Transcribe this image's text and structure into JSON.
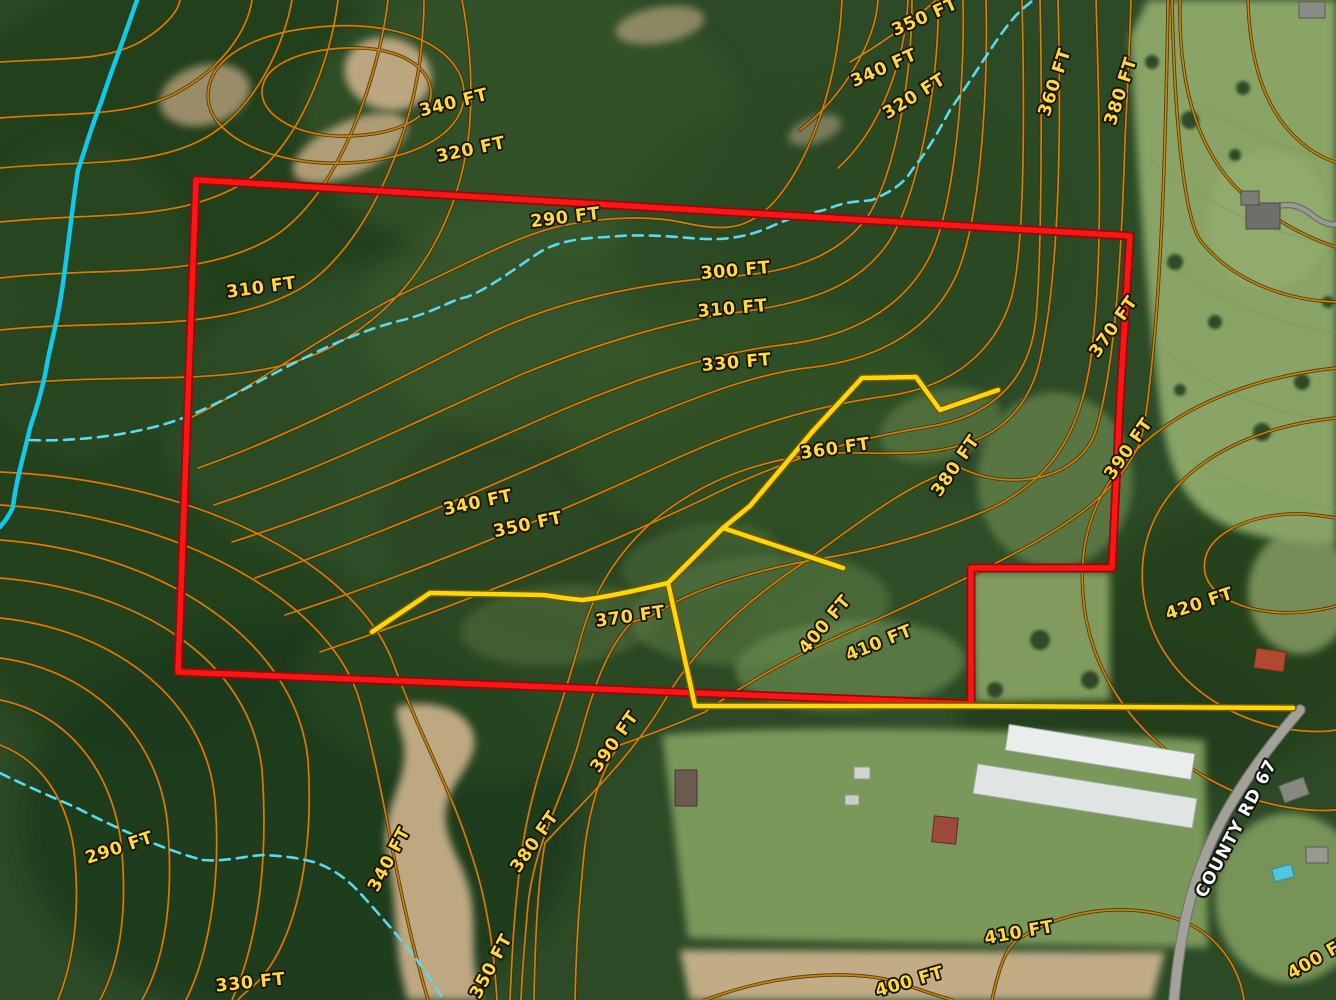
{
  "title": "Aerial topographic parcel map with contour lines, property boundary, trails and County Rd 67",
  "road_label": {
    "text": "COUNTY RD 67",
    "x": 1241,
    "y": 831,
    "rot": -62
  },
  "colors": {
    "forest": "#2c4a26",
    "forest_dark": "#213c1d",
    "forest_light": "#3e5e31",
    "contour": "#c8830b",
    "contour_casing": "#42310a",
    "label_fill": "#ffd83d",
    "boundary_red": "#ff1414",
    "boundary_casing": "#8f0c0c",
    "trail_yellow": "#ffd60a",
    "trail_casing": "#6f5600",
    "stream_solid": "#12c9ea",
    "stream_dashed": "#5cd9ef",
    "road_gray": "#a3a29a",
    "pasture": "#8ea969",
    "dirt": "#c6ae87"
  },
  "contour_labels": [
    {
      "t": "340 FT",
      "x": 455,
      "y": 108,
      "r": -14
    },
    {
      "t": "320 FT",
      "x": 472,
      "y": 155,
      "r": -12
    },
    {
      "t": "350 FT",
      "x": 927,
      "y": 22,
      "r": -24
    },
    {
      "t": "340 FT",
      "x": 886,
      "y": 73,
      "r": -24
    },
    {
      "t": "320 FT",
      "x": 917,
      "y": 101,
      "r": -32
    },
    {
      "t": "360 FT",
      "x": 1060,
      "y": 84,
      "r": -72
    },
    {
      "t": "380 FT",
      "x": 1126,
      "y": 93,
      "r": -72
    },
    {
      "t": "290 FT",
      "x": 566,
      "y": 223,
      "r": -7
    },
    {
      "t": "310 FT",
      "x": 262,
      "y": 293,
      "r": -8
    },
    {
      "t": "300 FT",
      "x": 736,
      "y": 276,
      "r": -5
    },
    {
      "t": "310 FT",
      "x": 733,
      "y": 314,
      "r": -5
    },
    {
      "t": "330 FT",
      "x": 737,
      "y": 368,
      "r": -5
    },
    {
      "t": "370 FT",
      "x": 1118,
      "y": 330,
      "r": -55
    },
    {
      "t": "360 FT",
      "x": 836,
      "y": 454,
      "r": -8
    },
    {
      "t": "380 FT",
      "x": 960,
      "y": 469,
      "r": -55
    },
    {
      "t": "390 FT",
      "x": 1133,
      "y": 452,
      "r": -55
    },
    {
      "t": "340 FT",
      "x": 479,
      "y": 508,
      "r": -12
    },
    {
      "t": "350 FT",
      "x": 529,
      "y": 530,
      "r": -12
    },
    {
      "t": "370 FT",
      "x": 631,
      "y": 622,
      "r": -8
    },
    {
      "t": "400 FT",
      "x": 829,
      "y": 628,
      "r": -50
    },
    {
      "t": "410 FT",
      "x": 881,
      "y": 648,
      "r": -22
    },
    {
      "t": "420 FT",
      "x": 1201,
      "y": 609,
      "r": -18
    },
    {
      "t": "290 FT",
      "x": 121,
      "y": 853,
      "r": -18
    },
    {
      "t": "340 FT",
      "x": 394,
      "y": 862,
      "r": -62
    },
    {
      "t": "330 FT",
      "x": 251,
      "y": 988,
      "r": -6
    },
    {
      "t": "390 FT",
      "x": 619,
      "y": 745,
      "r": -55
    },
    {
      "t": "380 FT",
      "x": 539,
      "y": 845,
      "r": -55
    },
    {
      "t": "350 FT",
      "x": 496,
      "y": 969,
      "r": -62
    },
    {
      "t": "410 FT",
      "x": 1020,
      "y": 938,
      "r": -10
    },
    {
      "t": "400 FT",
      "x": 911,
      "y": 987,
      "r": -16
    },
    {
      "t": "400 FT",
      "x": 1322,
      "y": 962,
      "r": -30
    }
  ],
  "contour_paths": [
    "M0,62 C55,58 105,62 140,42 C165,27 178,12 180,0",
    "M0,118 C70,112 130,118 178,92 C225,66 248,28 252,0",
    "M0,168 C85,160 150,168 205,138 C258,108 285,40 292,0",
    "M0,222 C100,212 175,222 240,185 C300,150 332,55 338,0",
    "M0,278 C110,266 195,280 268,240 C340,200 380,70 388,0",
    "M0,330 C120,318 215,335 298,290 C360,255 408,150 420,60 C423,35 424,15 424,0",
    "M0,385 C140,370 250,392 335,345 C425,295 465,200 470,120 C473,75 468,30 462,0",
    "M208,96 C208,56 258,30 332,26 C406,22 462,50 464,92 C466,130 420,160 346,163 C272,166 208,136 208,96 Z",
    "M262,92 C262,66 298,50 346,48 C398,46 430,66 431,92 C432,117 400,134 350,136 C300,138 262,117 262,92 Z",
    "M186,420 C250,390 330,330 400,295 C470,262 520,234 565,225 C612,216 655,216 685,223 C722,231 742,229 762,213 C800,184 838,95 842,0",
    "M198,468 C290,436 400,378 480,338 C560,298 650,282 735,276 C800,271 842,252 868,216 C896,172 912,75 912,0",
    "M214,505 C320,470 430,415 520,375 C610,338 690,318 733,313 C812,303 858,286 888,243 C918,198 940,80 938,0",
    "M232,542 C350,505 470,450 562,410 C652,372 722,352 782,345 C852,337 902,308 928,260 C955,210 965,80 963,0",
    "M255,578 C380,535 510,478 612,432 C702,394 760,372 815,367 C882,358 932,328 956,276 C982,218 988,80 986,0",
    "M285,615 C420,572 560,512 662,465 C752,423 822,405 887,396 C952,387 996,352 1012,296 C1026,238 1024,85 1022,0",
    "M320,652 C460,605 600,548 702,500 C792,455 864,437 927,427 C992,417 1030,380 1036,318 C1042,255 1042,85 1040,0",
    "M838,168 C880,130 905,62 908,0",
    "M800,130 C845,95 876,40 878,0",
    "M850,62 C888,40 920,15 936,0",
    "M1058,0 C1062,150 1058,280 1040,360 C1026,420 985,446 925,452 C880,455 858,452 835,453 C760,457 700,482 652,522 C610,560 590,600 578,648 C558,720 532,780 522,850 C514,910 512,955 510,1000",
    "M1096,0 C1100,130 1102,250 1094,330 C1086,432 1052,478 992,508 C942,530 885,548 825,558 C762,568 695,588 662,610 C650,618 638,620 632,622 C604,650 590,700 578,745 C562,800 534,845 528,905 C524,950 522,975 521,1000",
    "M1131,0 C1129,60 1127,100 1125,140 C1121,270 1114,370 1096,430 C1080,480 1010,492 961,468 C910,480 850,530 800,565 C740,605 690,655 665,700 C630,760 575,810 545,843 C538,880 535,940 534,1000",
    "M1168,0 C1166,130 1162,280 1150,380 C1145,430 1140,446 1134,454 C1114,492 1075,520 1030,545 C970,578 895,612 848,632 C790,657 735,690 705,712 C668,728 640,738 620,745 C600,770 590,810 585,845 C578,910 576,955 575,1000",
    "M0,745 C40,760 70,800 75,860 C80,920 72,965 58,1000",
    "M0,700 C70,714 116,775 122,853 C128,925 116,970 100,1000",
    "M0,658 C95,671 162,740 168,830 C174,910 162,965 142,1000",
    "M0,618 C115,630 206,700 215,800 C222,890 206,960 186,1000",
    "M0,578 C140,590 250,660 262,770 C270,880 252,955 232,1000",
    "M0,540 C162,552 296,640 308,760 C315,868 290,955 252,987 C246,992 240,997 238,1000",
    "M0,505 C180,516 332,602 360,702 C378,768 386,818 395,862 C403,902 414,952 428,1000",
    "M0,472 C192,480 352,560 392,660 C420,736 452,792 470,850 C488,902 494,952 497,1000",
    "M705,1000 C790,968 872,970 912,987 C935,995 945,998 952,1000",
    "M992,1000 C1000,962 1008,945 1020,938 C1072,906 1135,902 1185,922 C1222,938 1240,972 1244,1000",
    "M1336,418 C1235,428 1152,478 1143,560 C1135,642 1192,706 1272,726 C1302,733 1326,732 1336,730",
    "M1336,368 C1205,382 1092,448 1083,560 C1075,662 1135,748 1235,792 C1272,808 1312,812 1336,810",
    "M1336,606 C1330,608 1300,615 1272,612 C1228,607 1200,588 1205,560 C1210,530 1258,512 1304,514 C1318,515 1330,517 1336,518",
    "M1180,0 C1178,90 1200,160 1250,200 C1295,235 1330,245 1336,247",
    "M1248,0 C1250,70 1268,118 1308,148 C1322,158 1332,161 1336,162",
    "M1336,302 C1280,300 1230,278 1200,240 C1182,212 1174,100 1172,0"
  ],
  "forest_blobs": [
    [
      200,
      150,
      260,
      180,
      "#233f1e",
      0.9
    ],
    [
      520,
      120,
      220,
      140,
      "#35552b",
      0.7
    ],
    [
      150,
      520,
      200,
      260,
      "#24401f",
      0.8
    ],
    [
      420,
      420,
      260,
      160,
      "#32522a",
      0.6
    ],
    [
      620,
      520,
      240,
      140,
      "#2a4523",
      0.7
    ],
    [
      300,
      820,
      280,
      200,
      "#1f3a1c",
      0.85
    ],
    [
      560,
      320,
      200,
      120,
      "#3a5a2e",
      0.5
    ],
    [
      840,
      240,
      220,
      150,
      "#2b4824",
      0.7
    ],
    [
      930,
      620,
      180,
      120,
      "#30512a",
      0.6
    ],
    [
      1230,
      640,
      150,
      130,
      "#27431f",
      0.9
    ],
    [
      1120,
      720,
      160,
      90,
      "#223d1d",
      0.85
    ],
    [
      760,
      420,
      200,
      120,
      "#365628",
      0.5
    ],
    [
      80,
      300,
      120,
      160,
      "#2a4a24",
      0.7
    ],
    [
      480,
      680,
      180,
      100,
      "#2c4a24",
      0.6
    ]
  ],
  "dirt_shapes": [
    {
      "e": [
        388,
        74,
        44,
        36,
        15
      ],
      "f": "#c3ab85",
      "o": 0.95
    },
    {
      "e": [
        350,
        148,
        62,
        26,
        -25
      ],
      "f": "#bda67f",
      "o": 0.9
    },
    {
      "e": [
        205,
        95,
        46,
        30,
        -15
      ],
      "f": "#b7a07c",
      "o": 0.8
    },
    {
      "e": [
        660,
        25,
        45,
        18,
        -10
      ],
      "f": "#b3a07c",
      "o": 0.7
    },
    {
      "e": [
        815,
        130,
        28,
        13,
        -20
      ],
      "f": "#9b9274",
      "o": 0.7
    },
    {
      "p": "M398,706 C428,700 462,706 472,730 C482,756 458,772 448,800 C438,836 462,856 470,892 C478,928 468,962 482,1000 L408,1000 C392,950 398,900 388,860 C378,820 400,792 404,762 C408,736 392,722 398,706 Z",
      "f": "#c6ae87",
      "o": 0.95
    },
    {
      "p": "M680,950 L1165,952 L1152,1000 L690,1000 Z",
      "f": "#c9b28c",
      "o": 0.95
    }
  ],
  "pasture_shapes": [
    {
      "p": "M1130,36 C1136,150 1148,320 1162,420 C1175,505 1205,540 1336,545 L1336,0 L1148,0 Z",
      "f": "#8ea969",
      "o": 0.95
    },
    {
      "e": [
        1300,
        592,
        52,
        62,
        0
      ],
      "f": "#8aa066",
      "o": 0.8
    },
    {
      "p": "M972,572 L1110,572 L1110,700 L975,702 Z",
      "f": "#86a062",
      "o": 0.95
    },
    {
      "e": [
        1055,
        480,
        78,
        88,
        0
      ],
      "f": "#64804a",
      "o": 0.8
    },
    {
      "e": [
        940,
        425,
        62,
        35,
        -15
      ],
      "f": "#5d7a45",
      "o": 0.7
    },
    {
      "p": "M662,735 C760,726 980,726 1205,740 L1208,948 C1060,944 800,942 688,938 Z",
      "f": "#7d9b5b",
      "o": 0.97
    },
    {
      "e": [
        1290,
        898,
        75,
        85,
        0
      ],
      "f": "#85a061",
      "o": 0.85
    },
    {
      "e": [
        1268,
        220,
        60,
        70,
        0
      ],
      "f": "#93ad6e",
      "o": 0.8
    },
    {
      "e": [
        760,
        610,
        130,
        55,
        -5
      ],
      "f": "#5a7a42",
      "o": 0.6
    },
    {
      "e": [
        560,
        625,
        100,
        40,
        -5
      ],
      "f": "#546f3e",
      "o": 0.55
    },
    {
      "e": [
        850,
        665,
        115,
        45,
        -3
      ],
      "f": "#688a4e",
      "o": 0.7
    },
    {
      "e": [
        700,
        560,
        80,
        35,
        -10
      ],
      "f": "#50703c",
      "o": 0.5
    }
  ],
  "pasture_stripes": [
    "M1160,80 C1220,120 1280,150 1336,160",
    "M1150,160 C1210,205 1270,235 1336,245",
    "M1148,250 C1205,295 1268,325 1336,332",
    "M1152,340 C1205,385 1265,415 1336,420",
    "M1190,460 C1240,490 1300,505 1336,508"
  ],
  "tree_dots": [
    [
      1190,
      120,
      9
    ],
    [
      1243,
      88,
      7
    ],
    [
      1175,
      262,
      8
    ],
    [
      1215,
      322,
      7
    ],
    [
      1302,
      382,
      8
    ],
    [
      1262,
      432,
      9
    ],
    [
      1152,
      62,
      7
    ],
    [
      1328,
      302,
      6
    ],
    [
      1235,
      155,
      6
    ],
    [
      1180,
      390,
      6
    ],
    [
      1040,
      640,
      10
    ],
    [
      1090,
      680,
      9
    ],
    [
      995,
      690,
      8
    ]
  ],
  "streams": {
    "solid": "M137,0 C120,50 108,80 102,100 C90,130 82,160 78,170 C73,200 68,250 62,290 C56,330 50,345 46,370 C40,400 34,415 30,428 C24,455 16,480 13,507 C8,518 4,522 0,527",
    "dashed": [
      "M30,440 C80,442 140,434 183,418 C250,392 320,340 403,320 C440,310 450,300 467,297 C490,288 517,267 540,252 C560,240 585,238 607,237 C640,234 660,236 677,237 C700,239 715,240 730,238 C760,234 770,226 787,220 C810,212 820,212 830,208 C850,200 862,202 872,200 C890,192 903,185 912,170 C930,148 940,128 950,110 C975,75 995,40 1012,20 C1020,10 1028,5 1033,0",
      "M0,773 C30,788 55,798 77,808 C120,830 170,852 203,860 C225,862 245,856 263,855 C285,856 300,858 317,863 C335,870 348,880 360,893 C380,915 400,938 417,960 C428,975 436,988 444,1000"
    ]
  },
  "boundary": "M196,180 L1130,236 L1120,400 L1112,568 L971,568 L971,704 L178,672 Z",
  "trails": [
    "M998,390 L940,410 L916,377 L862,378 L813,431 L750,506 L723,528 L668,583",
    "M723,528 L843,568",
    "M668,583 C630,592 600,598 582,600 C560,598 552,596 543,595 L430,593 L372,632",
    "M668,583 L680,637 L693,697 L695,706 L970,706 L1293,708"
  ],
  "roads": [
    {
      "d": "M1300,710 C1270,745 1235,790 1212,840 C1192,882 1180,930 1174,1000",
      "w": 9,
      "c": "#a3a29a",
      "cas": "#75746c"
    },
    {
      "d": "M1262,212 C1285,200 1300,205 1312,215 C1325,225 1333,225 1336,224",
      "w": 4,
      "c": "#9b9b93",
      "cas": "#6f6f66"
    }
  ],
  "buildings": [
    {
      "x": 1100,
      "y": 752,
      "w": 188,
      "h": 26,
      "r": 9,
      "f": "#e9edeb",
      "s": "#9fa8a4"
    },
    {
      "x": 1085,
      "y": 796,
      "w": 222,
      "h": 30,
      "r": 9,
      "f": "#dfe5e2",
      "s": "#9fa8a4"
    },
    {
      "x": 945,
      "y": 830,
      "w": 24,
      "h": 26,
      "r": 6,
      "f": "#9c4a3c",
      "s": "#5e2d24"
    },
    {
      "x": 686,
      "y": 788,
      "w": 22,
      "h": 36,
      "r": 0,
      "f": "#6b5a4e",
      "s": "#453931"
    },
    {
      "x": 862,
      "y": 773,
      "w": 16,
      "h": 12,
      "r": 0,
      "f": "#cfd4cc",
      "s": "#999"
    },
    {
      "x": 852,
      "y": 800,
      "w": 14,
      "h": 10,
      "r": 0,
      "f": "#c9cec6",
      "s": "#999"
    },
    {
      "x": 1263,
      "y": 216,
      "w": 34,
      "h": 26,
      "r": 0,
      "f": "#6e6f6a",
      "s": "#4a4b47"
    },
    {
      "x": 1250,
      "y": 198,
      "w": 18,
      "h": 14,
      "r": 0,
      "f": "#7c7d77",
      "s": "#4a4b47"
    },
    {
      "x": 1312,
      "y": 10,
      "w": 26,
      "h": 16,
      "r": 0,
      "f": "#8a8b84",
      "s": "#5c5d57"
    },
    {
      "x": 1294,
      "y": 790,
      "w": 26,
      "h": 18,
      "r": -20,
      "f": "#878880",
      "s": "#5c5d57"
    },
    {
      "x": 1270,
      "y": 660,
      "w": 30,
      "h": 20,
      "r": 8,
      "f": "#b0492f",
      "s": "#6e2d1d"
    },
    {
      "x": 1317,
      "y": 855,
      "w": 22,
      "h": 16,
      "r": 0,
      "f": "#97988f",
      "s": "#5c5d57"
    },
    {
      "x": 1283,
      "y": 873,
      "w": 20,
      "h": 13,
      "r": -15,
      "f": "#4fc8de",
      "s": "#2a8ca0"
    }
  ]
}
